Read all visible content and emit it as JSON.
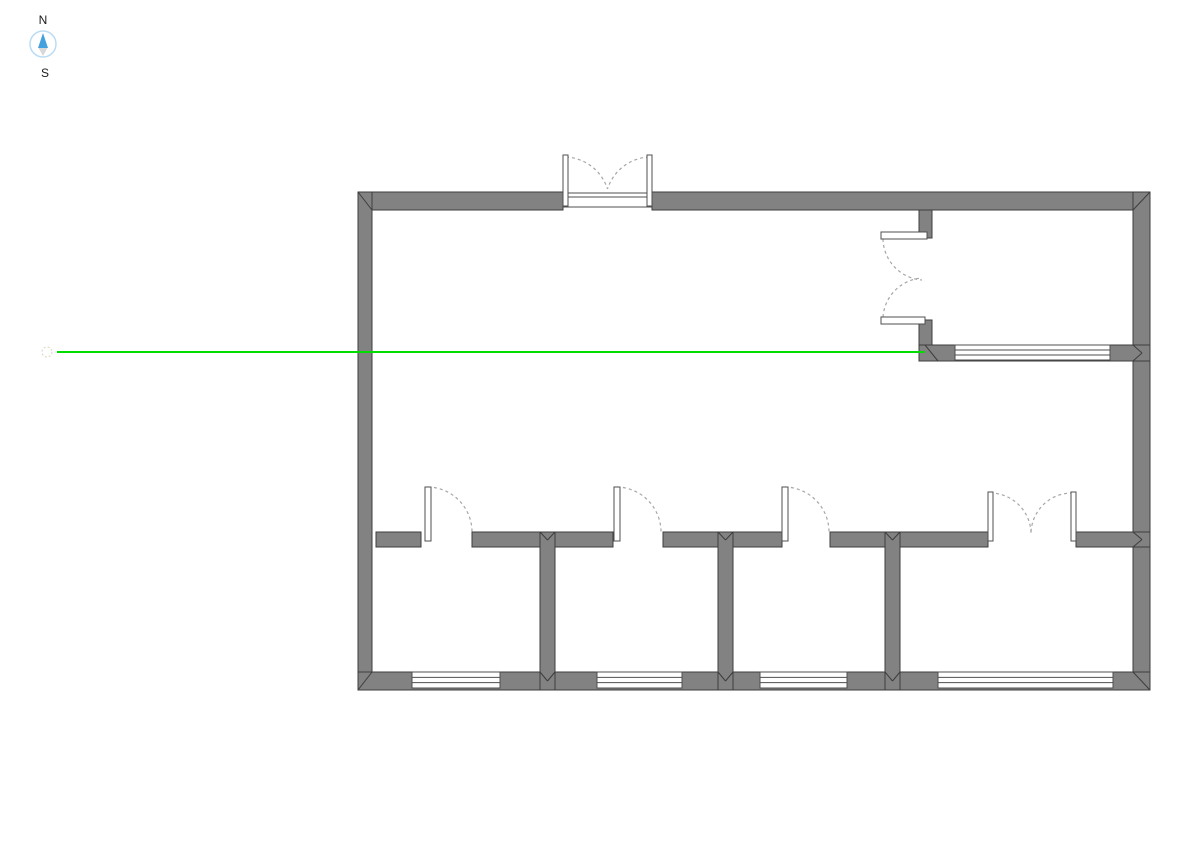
{
  "canvas": {
    "width": 1191,
    "height": 842,
    "background": "#ffffff"
  },
  "colors": {
    "wall_fill": "#828282",
    "wall_stroke": "#3d3d3d",
    "window_fill": "#ffffff",
    "window_stroke": "#4f4f4f",
    "door_leaf_fill": "#ffffff",
    "door_leaf_stroke": "#4f4f4f",
    "swing_arc": "#a6a6a6",
    "reference_line": "#00dc00",
    "reference_marker": "#d6d6ba",
    "compass_ring": "#badcf4",
    "compass_north": "#45a1dd",
    "compass_south": "#d8d8d8",
    "label_color": "#1a1a1a"
  },
  "compass": {
    "cx": 43,
    "cy": 44,
    "r": 13,
    "north_label": "N",
    "south_label": "S"
  },
  "reference_line": {
    "x1": 57,
    "y1": 352,
    "x2": 925,
    "y2": 352,
    "marker": {
      "cx": 47,
      "cy": 352,
      "r": 5
    }
  },
  "floor_plan": {
    "walls": [
      {
        "name": "outer-wall-top-left",
        "x": 358,
        "y": 192,
        "w": 205,
        "h": 18
      },
      {
        "name": "outer-wall-top-right",
        "x": 652,
        "y": 192,
        "w": 498,
        "h": 18
      },
      {
        "name": "outer-wall-left",
        "x": 358,
        "y": 192,
        "w": 14,
        "h": 498
      },
      {
        "name": "outer-wall-right",
        "x": 1133,
        "y": 192,
        "w": 17,
        "h": 498
      },
      {
        "name": "outer-wall-bottom",
        "x": 358,
        "y": 672,
        "w": 792,
        "h": 18
      },
      {
        "name": "interior-wall-stub-top-right",
        "x": 919,
        "y": 210,
        "w": 13,
        "h": 28
      },
      {
        "name": "interior-wall-top-right-lower",
        "x": 919,
        "y": 320,
        "w": 13,
        "h": 27
      },
      {
        "name": "interior-wall-horizontal-right",
        "x": 919,
        "y": 345,
        "w": 231,
        "h": 16
      },
      {
        "name": "interior-wall-mid-seg1",
        "x": 376,
        "y": 532,
        "w": 45,
        "h": 15
      },
      {
        "name": "interior-wall-mid-seg2",
        "x": 472,
        "y": 532,
        "w": 141,
        "h": 15
      },
      {
        "name": "interior-wall-mid-seg3",
        "x": 663,
        "y": 532,
        "w": 119,
        "h": 15
      },
      {
        "name": "interior-wall-mid-seg4",
        "x": 830,
        "y": 532,
        "w": 158,
        "h": 15
      },
      {
        "name": "interior-wall-mid-seg5",
        "x": 1076,
        "y": 532,
        "w": 74,
        "h": 15
      },
      {
        "name": "interior-wall-vertical-1",
        "x": 540,
        "y": 532,
        "w": 15,
        "h": 158
      },
      {
        "name": "interior-wall-vertical-2",
        "x": 718,
        "y": 532,
        "w": 15,
        "h": 158
      },
      {
        "name": "interior-wall-vertical-3",
        "x": 885,
        "y": 532,
        "w": 15,
        "h": 158
      }
    ],
    "windows": [
      {
        "name": "window-bottom-1",
        "x": 412,
        "y": 672,
        "w": 88,
        "h": 16
      },
      {
        "name": "window-bottom-2",
        "x": 597,
        "y": 672,
        "w": 85,
        "h": 16
      },
      {
        "name": "window-bottom-3",
        "x": 760,
        "y": 672,
        "w": 87,
        "h": 16
      },
      {
        "name": "window-bottom-4",
        "x": 938,
        "y": 672,
        "w": 175,
        "h": 16
      },
      {
        "name": "window-right-room",
        "x": 955,
        "y": 345,
        "w": 155,
        "h": 15
      }
    ],
    "door_sills": [
      {
        "name": "entrance-door-sill",
        "x": 563,
        "y": 193,
        "w": 89,
        "h": 14,
        "line_y": 197
      }
    ],
    "door_leaves": [
      {
        "name": "entrance-door-left-leaf",
        "x": 563,
        "y": 155,
        "w": 5,
        "h": 51
      },
      {
        "name": "entrance-door-right-leaf",
        "x": 647,
        "y": 155,
        "w": 5,
        "h": 51
      },
      {
        "name": "right-room-door-top-leaf",
        "x": 881,
        "y": 232,
        "w": 46,
        "h": 7
      },
      {
        "name": "right-room-door-bottom-leaf",
        "x": 881,
        "y": 317,
        "w": 44,
        "h": 7
      },
      {
        "name": "room1-door-leaf",
        "x": 425,
        "y": 487,
        "w": 6,
        "h": 54
      },
      {
        "name": "room2-door-leaf",
        "x": 614,
        "y": 487,
        "w": 6,
        "h": 54
      },
      {
        "name": "room3-door-leaf",
        "x": 782,
        "y": 487,
        "w": 6,
        "h": 54
      },
      {
        "name": "room4-door-left-leaf",
        "x": 988,
        "y": 492,
        "w": 5,
        "h": 49
      },
      {
        "name": "room4-door-right-leaf",
        "x": 1071,
        "y": 492,
        "w": 5,
        "h": 49
      }
    ],
    "door_swing_arcs": [
      {
        "name": "entrance-door-left-swing",
        "d": "M 566 157 A 46 46 0 0 1 607.5 189"
      },
      {
        "name": "entrance-door-right-swing",
        "d": "M 649 157 A 46 46 0 0 0 607.5 189"
      },
      {
        "name": "right-room-door-top-swing",
        "d": "M 883 239 A 42 42 0 0 0 922 280"
      },
      {
        "name": "right-room-door-bottom-swing",
        "d": "M 883 317 A 42 42 0 0 1 922 278"
      },
      {
        "name": "room1-door-swing",
        "d": "M 428 487 A 45 45 0 0 1 472 532"
      },
      {
        "name": "room2-door-swing",
        "d": "M 617 487 A 45 45 0 0 1 661 532"
      },
      {
        "name": "room3-door-swing",
        "d": "M 785 487 A 45 45 0 0 1 829 532"
      },
      {
        "name": "room4-door-left-swing",
        "d": "M 990 493 A 41 41 0 0 1 1031 533"
      },
      {
        "name": "room4-door-right-swing",
        "d": "M 1073 493 A 41 41 0 0 0 1031 533"
      }
    ],
    "corner_seams": [
      [
        358,
        192,
        372,
        210
      ],
      [
        1150,
        192,
        1133,
        210
      ],
      [
        358,
        690,
        372,
        672
      ],
      [
        1150,
        690,
        1133,
        672
      ],
      [
        540,
        532,
        547.5,
        540
      ],
      [
        555,
        532,
        547.5,
        540
      ],
      [
        540,
        672,
        547.5,
        681
      ],
      [
        555,
        672,
        547.5,
        681
      ],
      [
        718,
        532,
        725.5,
        540
      ],
      [
        733,
        532,
        725.5,
        540
      ],
      [
        718,
        672,
        725.5,
        681
      ],
      [
        733,
        672,
        725.5,
        681
      ],
      [
        885,
        532,
        892.5,
        540
      ],
      [
        900,
        532,
        892.5,
        540
      ],
      [
        885,
        672,
        892.5,
        681
      ],
      [
        900,
        672,
        892.5,
        681
      ],
      [
        925,
        345,
        938,
        361
      ],
      [
        1133,
        345,
        1142,
        353
      ],
      [
        1133,
        361,
        1142,
        353
      ],
      [
        1133,
        532,
        1142,
        539.5
      ],
      [
        1133,
        547,
        1142,
        539.5
      ]
    ]
  }
}
